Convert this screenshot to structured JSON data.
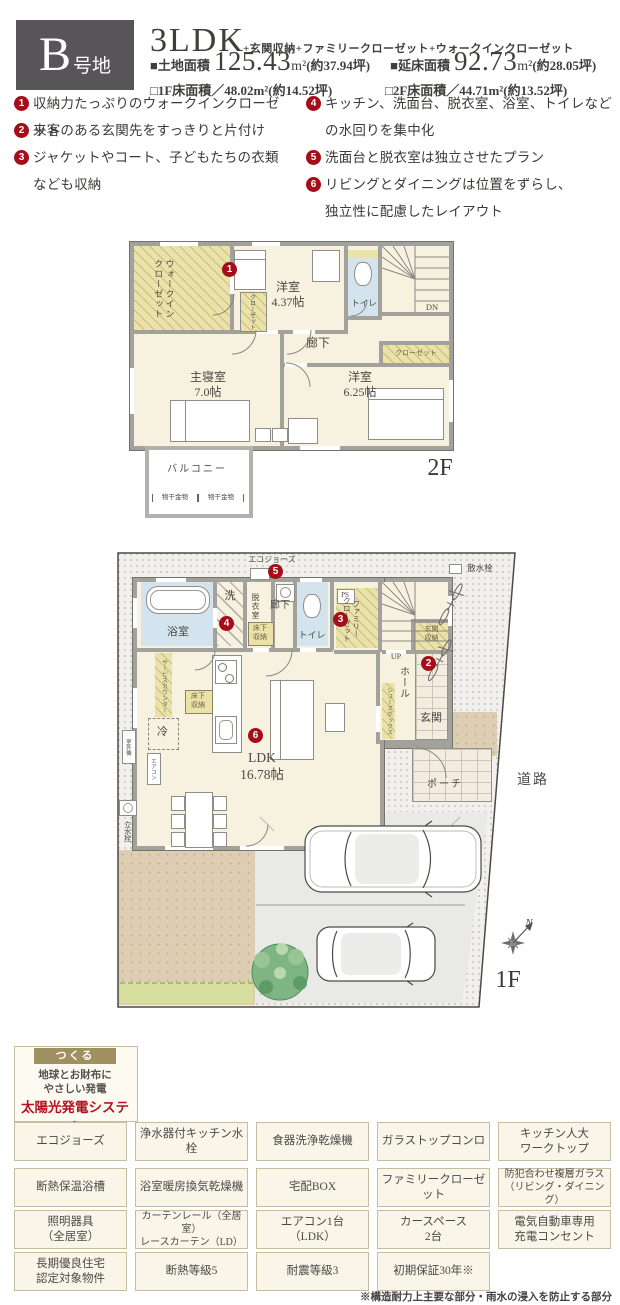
{
  "header": {
    "badge_big": "B",
    "badge_small": "号地",
    "plan_type": "3LDK",
    "plan_extras": "+玄関収納+ファミリークローゼット+ウォークインクローゼット",
    "land_label": "■土地面積",
    "land_value": "125.43",
    "land_unit": "m²",
    "land_tsubo": "(約37.94坪)",
    "floor_label": "■延床面積",
    "floor_value": "92.73",
    "floor_unit": "m²",
    "floor_tsubo": "(約28.05坪)",
    "f1_area": "□1F床面積／48.02m²(約14.52坪)",
    "f2_area": "□2F床面積／44.71m²(約13.52坪)"
  },
  "features": [
    {
      "num": "1",
      "text": "収納力たっぷりのウォークインクローゼット"
    },
    {
      "num": "2",
      "text": "来客のある玄関先をすっきりと片付け"
    },
    {
      "num": "3",
      "text": "ジャケットやコート、子どもたちの衣類なども収納"
    },
    {
      "num": "4",
      "text": "キッチン、洗面台、脱衣室、浴室、トイレなどの水回りを集中化"
    },
    {
      "num": "5",
      "text": "洗面台と脱衣室は独立させたプラン"
    },
    {
      "num": "6",
      "text": "リビングとダイニングは位置をずらし、独立性に配慮したレイアウト"
    }
  ],
  "floor2": {
    "floor_label": "2F",
    "wic": "ウォークイン\nクローゼット",
    "closet_small": "クローゼット",
    "closet_band": "クローゼット",
    "room_a": "洋室\n4.37帖",
    "toilet": "トイレ",
    "dn": "DN",
    "corridor": "廊下",
    "master": "主寝室\n7.0帖",
    "room_b": "洋室\n6.25帖",
    "balcony": "バルコニー",
    "hanger": "物干金物"
  },
  "floor1": {
    "floor_label": "1F",
    "eco_joz": "エコジョーズ",
    "sprinkler": "散水栓",
    "bath": "浴室",
    "laundry": "洗",
    "dressing": "脱衣室",
    "underfloor": "床下\n収納",
    "corridor": "廊下",
    "toilet": "トイレ",
    "ps": "PS",
    "family_closet": "ファミリー\nクローゼット",
    "up": "UP",
    "entrance_storage": "玄関\n収納",
    "hall": "ホール",
    "shoe_box": "シューズボックス",
    "entrance": "玄関",
    "service_counter": "サービスカウンター",
    "fridge": "冷",
    "aircon": "エアコン",
    "outdoor_unit": "室外機",
    "tap": "立水栓",
    "ldk": "LDK\n16.78帖",
    "porch": "ポーチ",
    "road": "道路",
    "north": "N"
  },
  "badges": {
    "b1": "1",
    "b2": "2",
    "b3": "3",
    "b4": "4",
    "b5": "5",
    "b6": "6"
  },
  "solar": {
    "ribbon": "つくる",
    "line1": "地球とお財布に",
    "line2": "やさしい発電",
    "title": "太陽光発電システム"
  },
  "amenities": [
    [
      "エコジョーズ",
      "浄水器付キッチン水栓",
      "食器洗浄乾燥機",
      "ガラストップコンロ",
      "キッチン人大\nワークトップ"
    ],
    [
      "断熱保温浴槽",
      "浴室暖房換気乾燥機",
      "宅配BOX",
      "ファミリークローゼット",
      "防犯合わせ複層ガラス\n（リビング・ダイニング）"
    ],
    [
      "照明器具\n（全居室）",
      "カーテンレール（全居室）\nレースカーテン（LD）",
      "エアコン1台\n（LDK）",
      "カースペース\n2台",
      "電気自動車専用\n充電コンセント"
    ],
    [
      "長期優良住宅\n認定対象物件",
      "断熱等級5",
      "耐震等級3",
      "初期保証30年※"
    ]
  ],
  "footnote": "※構造耐力上主要な部分・雨水の浸入を防止する部分"
}
